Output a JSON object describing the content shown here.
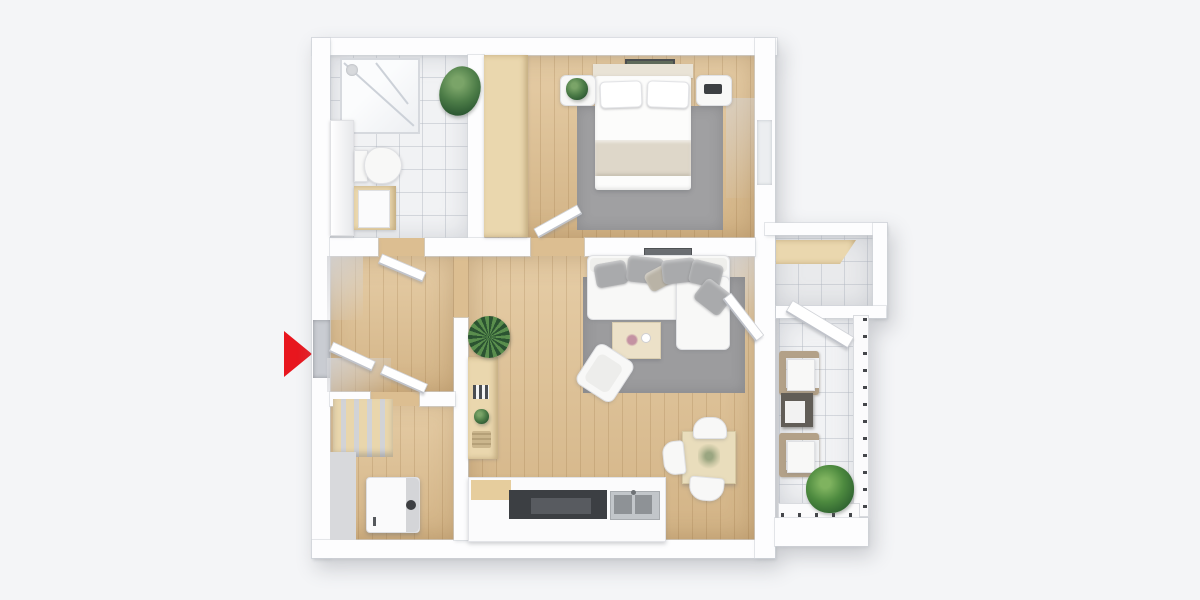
{
  "meta": {
    "type": "3d-floorplan-render",
    "view": "top-down",
    "description": "Top-down 3D render of a one-bedroom apartment with bathroom, bedroom, hallway, utility room, open living room with kitchen, and a side balcony",
    "visible_text": ""
  },
  "palette": {
    "background": "#f4f5f7",
    "wall": "#fdfdfe",
    "wall_edge": "#d0d3d9",
    "wood_floor": "#ddbf92",
    "wood_furniture": "#ead7ae",
    "tile_floor": "#f1f2f4",
    "tile_line": "#b0b6c0",
    "rug_gray": "#a0a0a2",
    "rug_living_gray": "#9c9c9e",
    "sofa_white": "#f8f8f7",
    "pillow_gray": "#a9aaac",
    "wicker_tan": "#b3a188",
    "cooktop_dark": "#3c3f43",
    "sink_gray": "#c2c6ca",
    "basin_gray": "#8e9296",
    "plant_green": "#4c7c47",
    "accent_red": "#e8161e",
    "tv_gray": "#6b6e72"
  },
  "entrance": {
    "marker": "red-arrow-icon",
    "direction": "right",
    "color": "#e8161e"
  },
  "rooms": [
    {
      "id": "bathroom",
      "floor": "white-tile",
      "features": [
        "glass-shower",
        "toilet",
        "wood-vanity-sink",
        "wall-cabinet",
        "corner-plant"
      ]
    },
    {
      "id": "bedroom",
      "floor": "wood",
      "features": [
        "double-bed",
        "two-pillows",
        "beige-blanket",
        "wardrobe",
        "nightstand-with-plant",
        "nightstand-with-radio",
        "gray-rug",
        "wall-art",
        "open-door",
        "window"
      ]
    },
    {
      "id": "hallway",
      "floor": "wood",
      "features": [
        "entrance-door",
        "bathroom-door",
        "utility-door",
        "opening-to-living-room"
      ]
    },
    {
      "id": "utility-room",
      "floor": "wood",
      "features": [
        "washing-machine",
        "slatted-shelf"
      ]
    },
    {
      "id": "living-room",
      "floor": "wood",
      "features": [
        "corner-sofa",
        "six-gray-pillows",
        "gray-rug",
        "coffee-table",
        "armchair",
        "bookshelf",
        "tall-plant",
        "dining-table",
        "three-chairs",
        "kitchen-counter",
        "cooktop",
        "double-sink",
        "wall-tv",
        "balcony-door"
      ]
    },
    {
      "id": "balcony",
      "floor": "white-tile",
      "features": [
        "wicker-chair",
        "wicker-chair",
        "side-table",
        "plant",
        "railing",
        "white-awning"
      ]
    },
    {
      "id": "storage-niche",
      "floor": "gray-tile",
      "features": [
        "wood-beam-shelf"
      ]
    }
  ]
}
